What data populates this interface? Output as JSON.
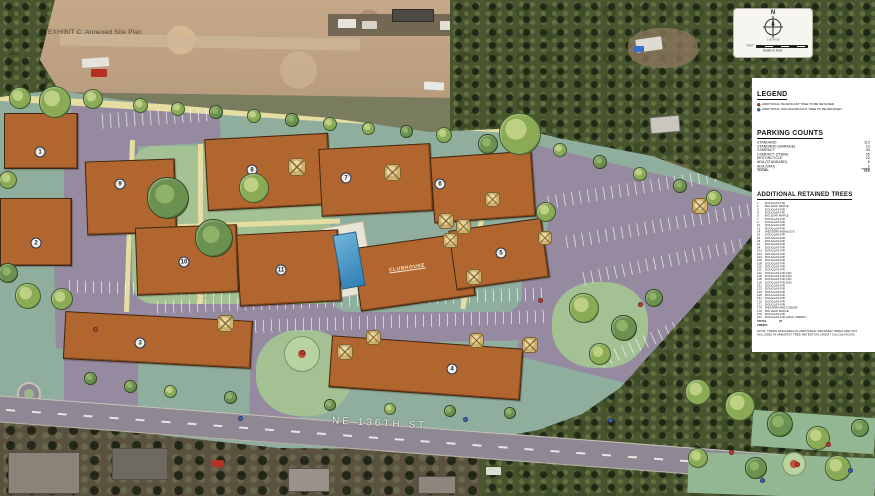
{
  "title": "EXHIBIT C: Annexed Site Plan",
  "north_box": {
    "north": "N",
    "scale_ticks": "0  20  40        80",
    "feet_label": "FEET",
    "scale_label": "Scale In Feet"
  },
  "panel": {
    "legend": {
      "title": "LEGEND",
      "items": [
        {
          "color": "#c23b35",
          "label": "ADDITIONAL SIGNIFICANT TREE TO BE RETAINED"
        },
        {
          "color": "#3f62b5",
          "label": "ADDITIONAL NON-SIGNIFICANT TREE TO BE RETAINED"
        }
      ]
    },
    "parking": {
      "title": "PARKING COUNTS",
      "rows": [
        {
          "label": "STANDARD",
          "value": "110"
        },
        {
          "label": "STANDARD (GARAGE)",
          "value": "13"
        },
        {
          "label": "COMPACT",
          "value": "40"
        },
        {
          "label": "COMPACT (TNDM)",
          "value": "35"
        },
        {
          "label": "MOTORCYCLE",
          "value": "10"
        },
        {
          "label": "ADA (STANDARD)",
          "value": "6"
        },
        {
          "label": "ADA (VAN)",
          "value": "2"
        },
        {
          "label": "TOTAL",
          "value": "216"
        }
      ]
    },
    "trees": {
      "title": "ADDITIONAL RETAINED TREES",
      "items": [
        {
          "id": "1",
          "species": "DOUGLAS-FIR"
        },
        {
          "id": "2",
          "species": "BIG LEAF MAPLE"
        },
        {
          "id": "3",
          "species": "DOUGLAS-FIR"
        },
        {
          "id": "4",
          "species": "DOUGLAS-FIR"
        },
        {
          "id": "5",
          "species": "BIG LEAF MAPLE"
        },
        {
          "id": "7",
          "species": "DOUGLAS-FIR"
        },
        {
          "id": "9",
          "species": "DOUGLAS-FIR"
        },
        {
          "id": "10",
          "species": "DOUGLAS-FIR"
        },
        {
          "id": "12",
          "species": "DOUGLAS-FIR"
        },
        {
          "id": "14",
          "species": "WESTERN HEMLOCK"
        },
        {
          "id": "15",
          "species": "DOUGLAS-FIR"
        },
        {
          "id": "16",
          "species": "DOUGLAS-FIR"
        },
        {
          "id": "18",
          "species": "DOUGLAS-FIR"
        },
        {
          "id": "21",
          "species": "DOUGLAS-FIR"
        },
        {
          "id": "24",
          "species": "DOUGLAS-FIR"
        },
        {
          "id": "101",
          "species": "DOUGLAS-FIR"
        },
        {
          "id": "103",
          "species": "DOUGLAS-FIR"
        },
        {
          "id": "104",
          "species": "DOUGLAS-FIR"
        },
        {
          "id": "106",
          "species": "DOUGLAS-FIR"
        },
        {
          "id": "108",
          "species": "DOUGLAS-FIR"
        },
        {
          "id": "110",
          "species": "DOUGLAS-FIR"
        },
        {
          "id": "111",
          "species": "DOUGLAS-FIR"
        },
        {
          "id": "114",
          "species": "DOUGLAS-FIR (HS)"
        },
        {
          "id": "116",
          "species": "DOUGLAS-FIR (HS)"
        },
        {
          "id": "118",
          "species": "DOUGLAS-FIR (HS)"
        },
        {
          "id": "119",
          "species": "DOUGLAS-FIR (HS)"
        },
        {
          "id": "121",
          "species": "DOUGLAS-FIR"
        },
        {
          "id": "123",
          "species": "DOUGLAS-FIR"
        },
        {
          "id": "126",
          "species": "DOUGLAS-FIR"
        },
        {
          "id": "128",
          "species": "DOUGLAS-FIR"
        },
        {
          "id": "131",
          "species": "DOUGLAS-FIR"
        },
        {
          "id": "170",
          "species": "DOUGLAS-FIR"
        },
        {
          "id": "171",
          "species": "DOUGLAS-FIR"
        },
        {
          "id": "176",
          "species": "WESTERN RED CEDAR"
        },
        {
          "id": "178",
          "species": "BIG LEAF MAPLE"
        },
        {
          "id": "179",
          "species": "DOUGLAS-FIR"
        },
        {
          "id": "214",
          "species": "DOUGLAS-FIR (HALF CREDIT)"
        }
      ],
      "total_label": "TOTAL TREES:",
      "total_value": "37",
      "note": "NOTE: TREES SPECIFIED AS ADDITIONAL RETAINED TREES ARE NOT INCLUDED IN ARBORIST TREE RETENTION CREDIT CALCULATIONS."
    }
  },
  "site": {
    "street_label": "NE 136TH ST",
    "clubhouse_label": "CLUBHOUSE",
    "buildings": [
      {
        "number": "1"
      },
      {
        "number": "2"
      },
      {
        "number": "3"
      },
      {
        "number": "4"
      },
      {
        "number": "5"
      },
      {
        "number": "6"
      },
      {
        "number": "7"
      },
      {
        "number": "8"
      },
      {
        "number": "9"
      },
      {
        "number": "10"
      },
      {
        "number": "11"
      }
    ]
  }
}
